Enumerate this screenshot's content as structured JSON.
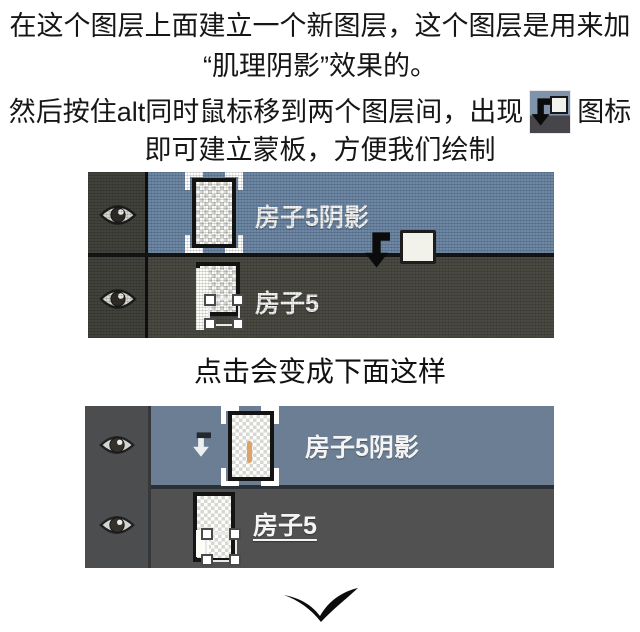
{
  "instructions": {
    "line1": "在这个图层上面建立一个新图层，这个图层是用来加",
    "line2": "“肌理阴影”效果的。",
    "line3_before": "然后按住alt同时鼠标移到两个图层间，出现",
    "line3_after": "图标",
    "line4": "即可建立蒙板，方便我们绘制"
  },
  "caption": "点击会变成下面这样",
  "panels": {
    "before": {
      "style": "textured screenshot",
      "layers": [
        {
          "name": "房子5阴影",
          "selected": true,
          "visible": true
        },
        {
          "name": "房子5",
          "selected": false,
          "visible": true
        }
      ]
    },
    "after": {
      "style": "flat screenshot",
      "layers": [
        {
          "name": "房子5阴影",
          "selected": true,
          "visible": true,
          "clipped": true
        },
        {
          "name": "房子5",
          "selected": false,
          "visible": true
        }
      ]
    }
  },
  "icons": {
    "inline_clip_cursor": "clipping-mask-cursor",
    "eye": "layer-visibility-eye",
    "clip_arrow": "clipping-bent-arrow",
    "chevron": "continue-down-chevron"
  },
  "colors": {
    "before_selected_row": "#6d88a6",
    "before_dark_row": "#4a4a43",
    "before_eye_col": "#42423c",
    "after_selected_row": "#6b7e94",
    "after_dark_row": "#515152",
    "after_eye_col": "#4b4d4f",
    "shadow_paint": "#dfa266",
    "divider": "#15161a"
  }
}
